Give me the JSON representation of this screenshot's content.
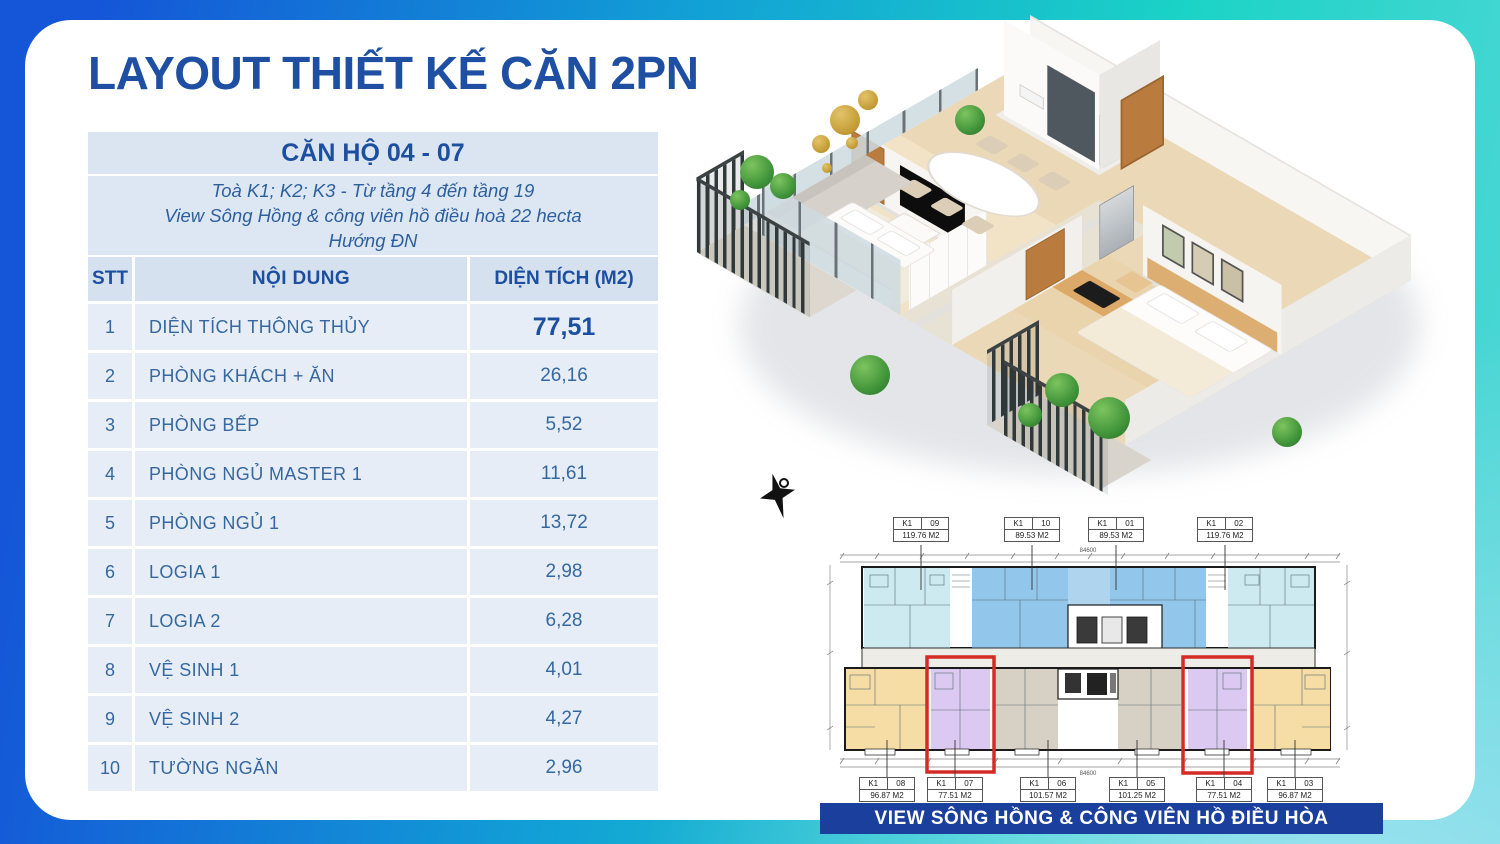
{
  "title": "LAYOUT THIẾT KẾ CĂN 2PN",
  "table": {
    "header": "CĂN HỘ 04 - 07",
    "subtitle_lines": [
      "Toà K1; K2; K3 - Từ tầng 4 đến tầng 19",
      "View Sông Hồng & công viên hồ điều hoà 22 hecta",
      "Hướng ĐN"
    ],
    "columns": [
      "STT",
      "NỘI DUNG",
      "DIỆN TÍCH (M2)"
    ],
    "rows": [
      {
        "stt": "1",
        "noi_dung": "DIỆN TÍCH THÔNG THỦY",
        "dien_tich": "77,51"
      },
      {
        "stt": "2",
        "noi_dung": "PHÒNG KHÁCH + ĂN",
        "dien_tich": "26,16"
      },
      {
        "stt": "3",
        "noi_dung": "PHÒNG BẾP",
        "dien_tich": "5,52"
      },
      {
        "stt": "4",
        "noi_dung": "PHÒNG NGỦ MASTER 1",
        "dien_tich": "11,61"
      },
      {
        "stt": "5",
        "noi_dung": "PHÒNG NGỦ 1",
        "dien_tich": "13,72"
      },
      {
        "stt": "6",
        "noi_dung": "LOGIA 1",
        "dien_tich": "2,98"
      },
      {
        "stt": "7",
        "noi_dung": "LOGIA 2",
        "dien_tich": "6,28"
      },
      {
        "stt": "8",
        "noi_dung": "VỆ SINH 1",
        "dien_tich": "4,01"
      },
      {
        "stt": "9",
        "noi_dung": "VỆ SINH 2",
        "dien_tich": "4,27"
      },
      {
        "stt": "10",
        "noi_dung": "TƯỜNG NGĂN",
        "dien_tich": "2,96"
      }
    ]
  },
  "floor_plan": {
    "overall_dim": "84600",
    "top_units": [
      {
        "block": "K1",
        "unit": "09",
        "area": "119.76 M2"
      },
      {
        "block": "K1",
        "unit": "10",
        "area": "89.53 M2"
      },
      {
        "block": "K1",
        "unit": "01",
        "area": "89.53 M2"
      },
      {
        "block": "K1",
        "unit": "02",
        "area": "119.76 M2"
      }
    ],
    "bottom_units": [
      {
        "block": "K1",
        "unit": "08",
        "area": "96.87 M2"
      },
      {
        "block": "K1",
        "unit": "07",
        "area": "77.51 M2"
      },
      {
        "block": "K1",
        "unit": "06",
        "area": "101.57 M2"
      },
      {
        "block": "K1",
        "unit": "05",
        "area": "101.25 M2"
      },
      {
        "block": "K1",
        "unit": "04",
        "area": "77.51 M2"
      },
      {
        "block": "K1",
        "unit": "03",
        "area": "96.87 M2"
      }
    ]
  },
  "banner": {
    "text": "VIEW SÔNG HỒNG & CÔNG VIÊN  HỒ ĐIỀU HÒA"
  },
  "colors": {
    "accent_blue": "#1d4fa1",
    "banner_bg": "#1a3f9d",
    "highlight_red": "#d42b26",
    "teal": "#1bd3c6"
  }
}
